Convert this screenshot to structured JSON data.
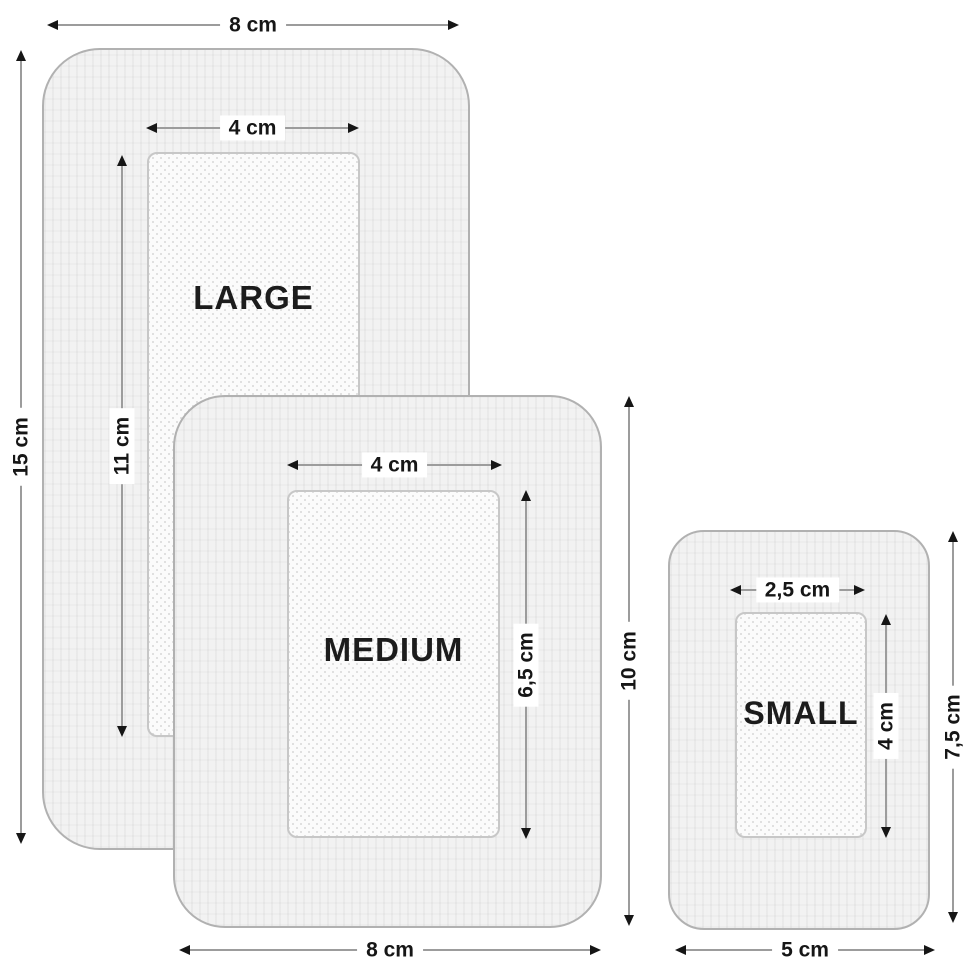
{
  "figure": {
    "type": "bandage-size-diagram",
    "background_color": "#ffffff",
    "body_fill": "#f2f2f2",
    "pad_fill": "#fbfbfb",
    "outline_color": "#b1b1b1",
    "dimension_line_color": "#9c9c9c",
    "arrow_color": "#161616",
    "text_color": "#1c1c1c"
  },
  "bandages": {
    "large": {
      "name": "LARGE",
      "outer_width": "8 cm",
      "outer_height": "15 cm",
      "pad_width": "4 cm",
      "pad_height": "11 cm"
    },
    "medium": {
      "name": "MEDIUM",
      "outer_width": "8 cm",
      "outer_height": "10 cm",
      "pad_width": "4 cm",
      "pad_height": "6,5 cm"
    },
    "small": {
      "name": "SMALL",
      "outer_width": "5 cm",
      "outer_height": "7,5 cm",
      "pad_width": "2,5 cm",
      "pad_height": "4 cm"
    }
  }
}
